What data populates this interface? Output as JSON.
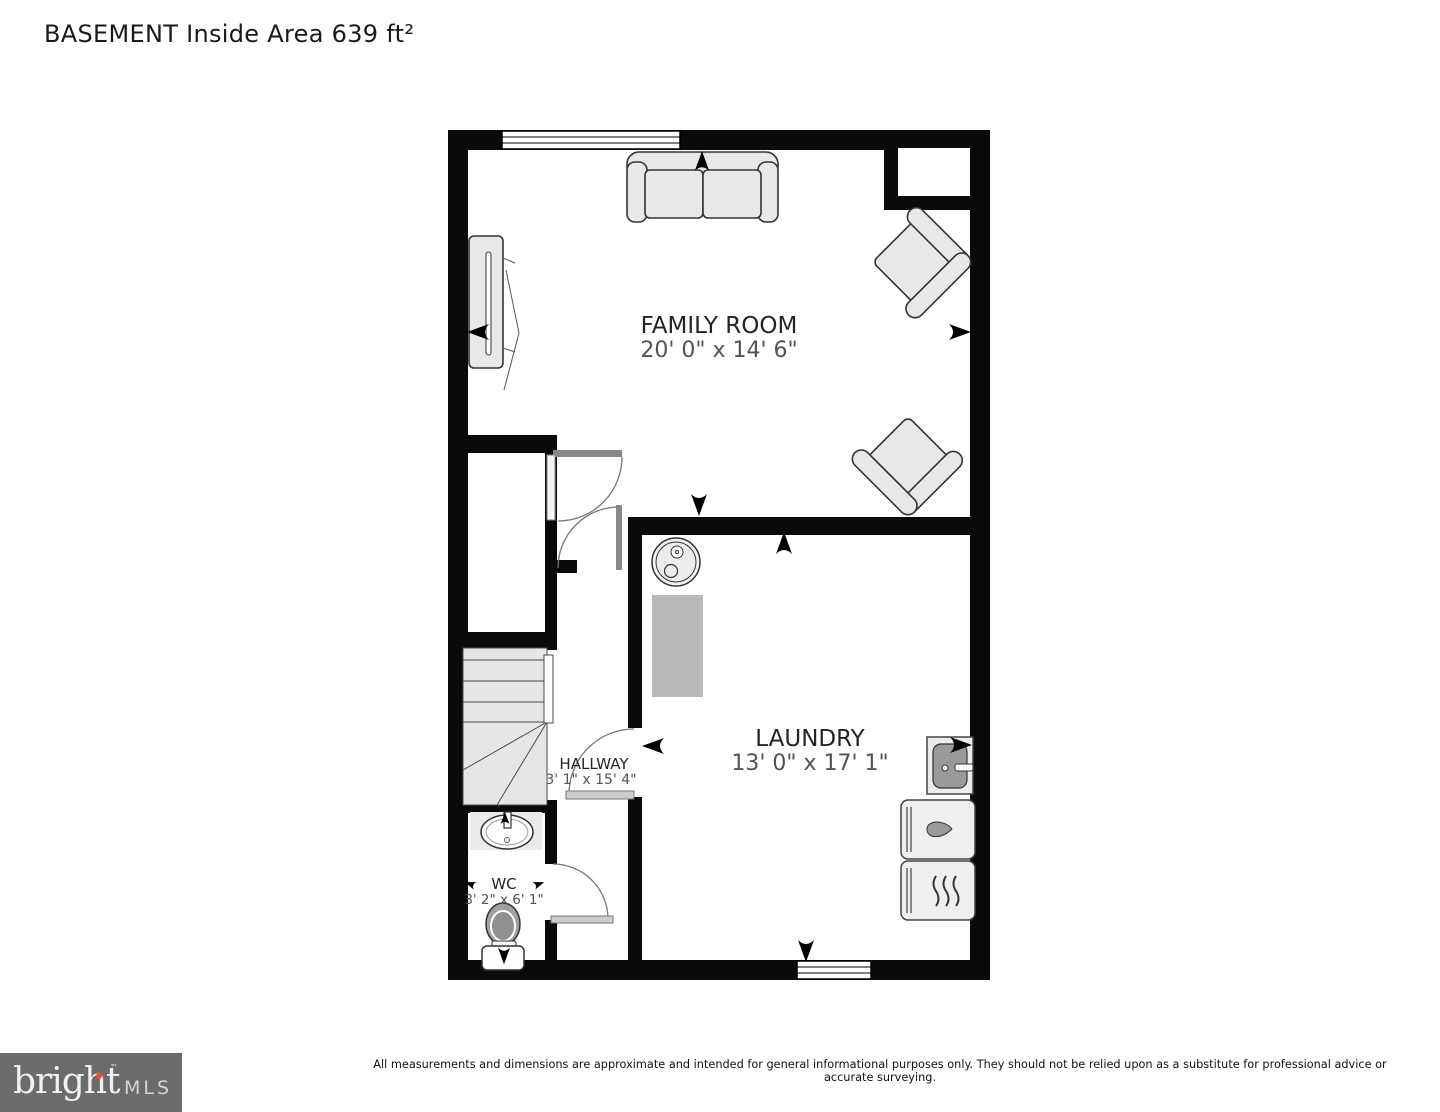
{
  "title": "BASEMENT Inside Area 639 ft²",
  "plan": {
    "rooms": [
      {
        "name": "FAMILY ROOM",
        "dims": "20' 0\" x 14' 6\""
      },
      {
        "name": "LAUNDRY",
        "dims": "13' 0\" x 17' 1\""
      },
      {
        "name": "HALLWAY",
        "dims": "3' 1\" x 15' 4\""
      },
      {
        "name": "WC",
        "dims": "3' 2\" x 6' 1\""
      }
    ],
    "icons": [
      "sofa-icon",
      "tv-icon",
      "armchair-icon",
      "water-heater-icon",
      "counter-icon",
      "utility-sink-icon",
      "washer-icon",
      "dryer-icon",
      "bathroom-sink-icon",
      "toilet-icon",
      "stairs-icon",
      "window-icon",
      "door-arc-icon",
      "direction-arrow-icon"
    ],
    "colors": {
      "wall": "#0a0a0a",
      "furniture_fill": "#e8e8e6",
      "furniture_stroke": "#333333",
      "counter_gray": "#b9b9b9",
      "appliance_gray": "#9a9a9a",
      "door_arc": "#777777",
      "stairs_fill": "#e6e6e6"
    }
  },
  "footer": {
    "disclaimer": "All measurements and dimensions are approximate and intended for general informational purposes only. They should not be relied upon as a substitute for professional advice or accurate surveying.",
    "logo": {
      "brand": "bright",
      "star": "✦",
      "tm": "™",
      "suffix": "MLS",
      "bg_color": "#696b6d",
      "accent_color": "#e8532e"
    }
  }
}
